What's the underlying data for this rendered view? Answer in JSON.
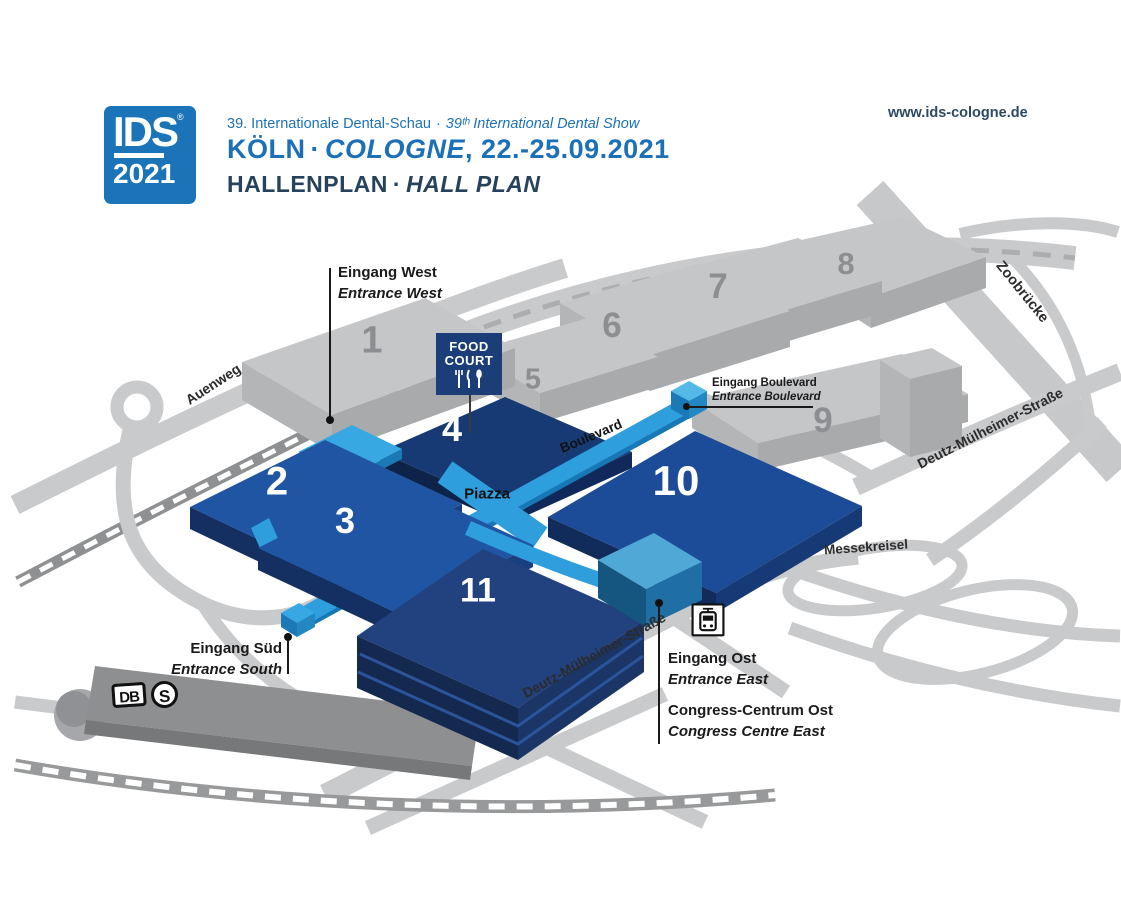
{
  "header": {
    "logo_text": "IDS",
    "logo_reg": "®",
    "logo_year": "2021",
    "subtitle_de": "39. Internationale Dental-Schau",
    "subtitle_sep": "·",
    "subtitle_en": "39ᵗʰ International Dental Show",
    "title_de": "KÖLN",
    "title_sep": "·",
    "title_en": "COLOGNE",
    "title_date": ", 22.-25.09.2021",
    "plan_de": "HALLENPLAN",
    "plan_sep": "·",
    "plan_en": "HALL PLAN",
    "website": "www.ids-cologne.de"
  },
  "map": {
    "halls": {
      "h1": "1",
      "h2": "2",
      "h3": "3",
      "h4": "4",
      "h5": "5",
      "h6": "6",
      "h7": "7",
      "h8": "8",
      "h9": "9",
      "h10": "10",
      "h11": "11"
    },
    "streets": {
      "auenweg": "Auenweg",
      "zoobruecke": "Zoobrücke",
      "deutz_right": "Deutz-Mülheimer-Straße",
      "deutz_bottom": "Deutz-Mülheimer-Straße",
      "messekreisel": "Messekreisel",
      "boulevard": "Boulevard",
      "piazza": "Piazza"
    },
    "food_court": {
      "line1": "FOOD",
      "line2": "COURT"
    },
    "entrances": {
      "west": {
        "de": "Eingang West",
        "en": "Entrance West"
      },
      "boulevard": {
        "de": "Eingang Boulevard",
        "en": "Entrance Boulevard"
      },
      "south": {
        "de": "Eingang Süd",
        "en": "Entrance South"
      },
      "east": {
        "de": "Eingang Ost",
        "en": "Entrance East"
      }
    },
    "congress": {
      "de": "Congress-Centrum Ost",
      "en": "Congress Centre East"
    },
    "transit": {
      "db": "DB",
      "sbahn": "S"
    }
  },
  "colors": {
    "brand_blue": "#1B74B8",
    "heading_navy": "#27425C",
    "hall_dark_navy": "#1C3E78",
    "hall_blue": "#1F55A2",
    "walkway_blue": "#2E9EDC",
    "entrance_blue": "#38A8E2",
    "congress_blue": "#4FA8D6",
    "road_gray": "#C9CACC",
    "building_gray": "#C5C6C8",
    "station_gray": "#8D8F91",
    "label_black": "#1A1A1A"
  }
}
